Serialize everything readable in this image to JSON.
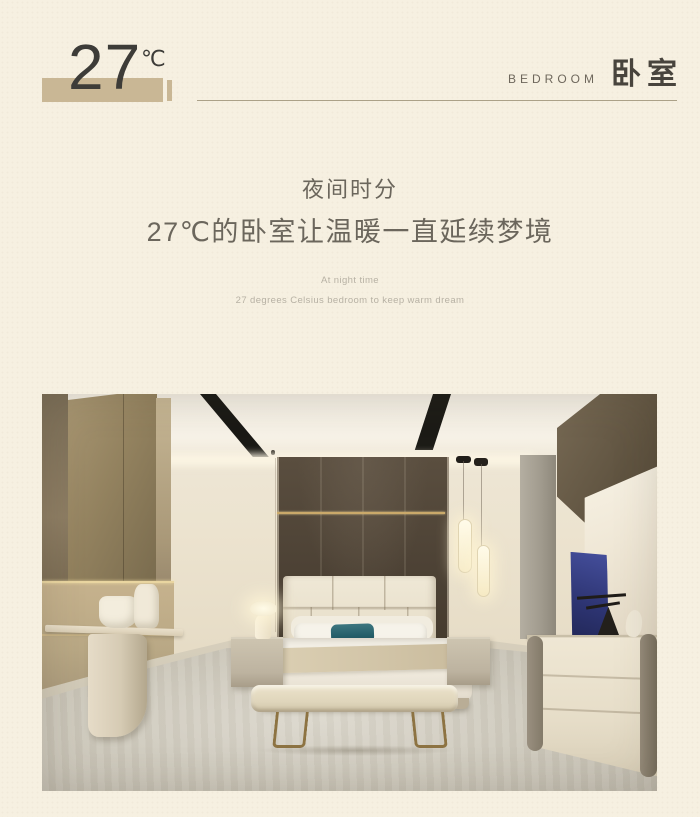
{
  "page": {
    "background_color": "#f6f0e1",
    "accent_color": "#c9b795",
    "heading_text_color": "#3d3c38",
    "body_text_color": "#6b665c",
    "muted_text_color": "#b7b1a4"
  },
  "header": {
    "temperature_value": "27",
    "temperature_unit": "℃",
    "section_label_en": "BEDROOM",
    "section_label_zh": "卧室"
  },
  "intro": {
    "title_zh_line1": "夜间时分",
    "title_zh_line2": "27℃的卧室让温暖一直延续梦境",
    "subtitle_en_line1": "At night time",
    "subtitle_en_line2": "27 degrees Celsius bedroom to keep warm dream"
  },
  "photo": {
    "description": "Warm modern bedroom showroom: cream padded headboard bed with teal pillow, dark bronze panel wall with gold trim, tube pendant lights, bench with brass legs, nightstand lamp, console table, cream dresser with sculptures, pale carpet"
  }
}
